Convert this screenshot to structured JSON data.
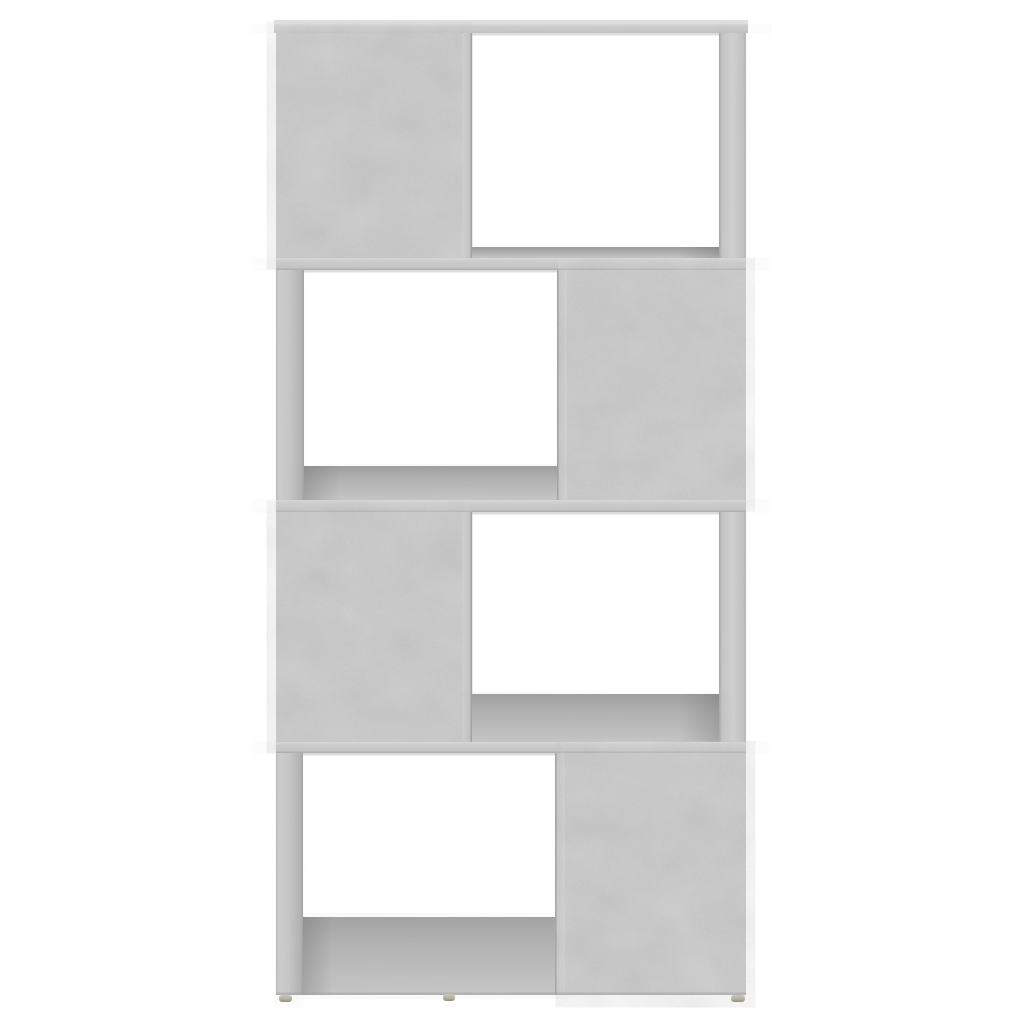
{
  "scene": {
    "type": "product-photo",
    "subject": "Bookcase / room divider, 4-tier zigzag cube design",
    "finish": "concrete grey",
    "background_description": "plain white studio background, no text or UI elements",
    "tiers": [
      {
        "position": 1,
        "solid_panel": "left",
        "open_compartment": "right"
      },
      {
        "position": 2,
        "solid_panel": "right",
        "open_compartment": "left"
      },
      {
        "position": 3,
        "solid_panel": "left",
        "open_compartment": "right"
      },
      {
        "position": 4,
        "solid_panel": "right",
        "open_compartment": "left"
      }
    ],
    "feet": {
      "count": 3,
      "positions": [
        "left",
        "center",
        "right"
      ]
    }
  },
  "palette": {
    "background": "#ffffff",
    "concrete_base": "#c6c6c6",
    "concrete_light": "#d4d4d4",
    "concrete_dark": "#b2b2b2",
    "board_edge": "#cbcbcb",
    "top_highlight": "#dfdfdf",
    "shelf_shadow": "#9e9e9e",
    "seam": "#9a9a9a",
    "foot_light": "#c9c6b8",
    "foot_dark": "#94917f"
  }
}
